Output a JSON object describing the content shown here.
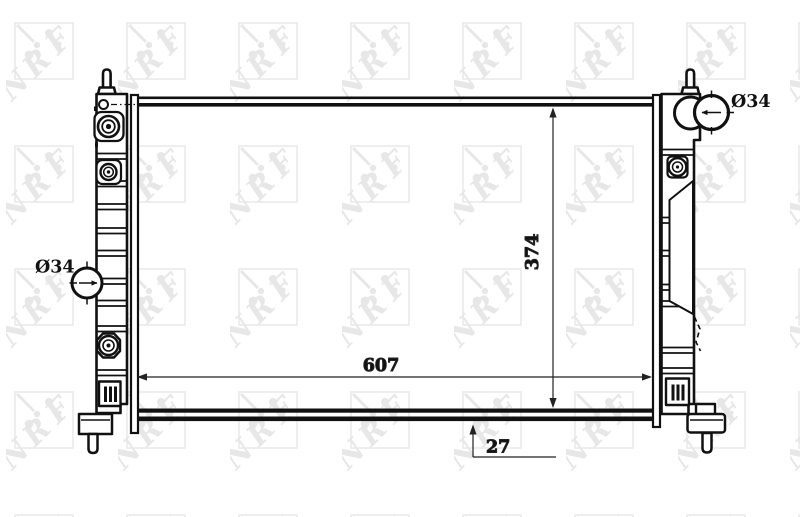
{
  "page": {
    "description": "Technical line drawing of an automotive radiator with dimension annotations",
    "brand": "NRF"
  },
  "watermark": {
    "letters": [
      "N",
      "R",
      "F"
    ],
    "color": "#e7e7e7"
  },
  "labels": {
    "left_port_diameter": "Ø34",
    "right_port_diameter": "Ø34",
    "core_width": "607",
    "core_height": "374",
    "core_depth": "27"
  },
  "colors": {
    "line": "#111111",
    "dimension": "#222222",
    "background": "#ffffff",
    "watermark": "#e7e7e7"
  }
}
